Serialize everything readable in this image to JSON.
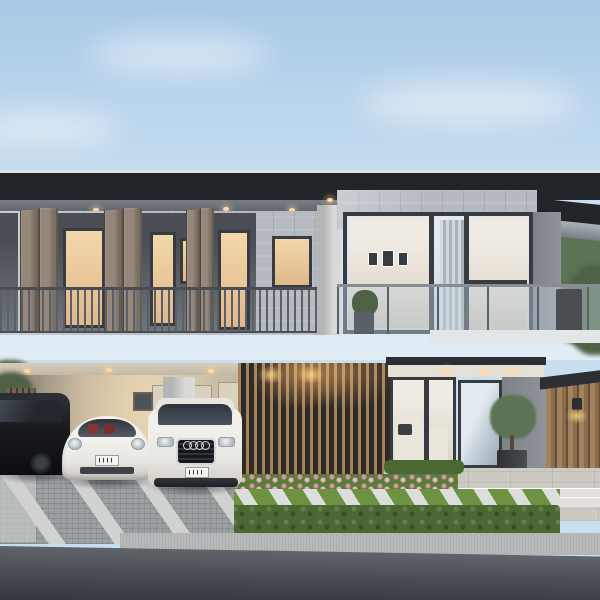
{
  "scene": {
    "type": "architectural exterior rendering",
    "time_of_day": "dusk with interior lights on",
    "description": "Modern two-storey house with dark flat cantilevered roof, stone-clad upper facade with folding taupe shutters and lit glass doors, full-height glazed corner, glass and metal balustrades, timber slat entrance screen, carport with three vehicles, manicured hedge, lawn with diagonal stepping stones and asphalt road in the foreground",
    "objects": [
      "sky",
      "clouds",
      "flat-roof",
      "eave-downlights",
      "stone-wall",
      "folding-shutters",
      "balcony-railing",
      "glass-balustrade",
      "balcony-plant",
      "picture-frames",
      "vertical-blinds",
      "carport",
      "carport-downlights",
      "white-column",
      "black-minivan",
      "white-sports-coupe",
      "white-suv",
      "license-plate",
      "timber-slat-screen",
      "timber-door",
      "living-room-glazing",
      "white-sofa",
      "topiary-tree-in-planter",
      "timber-clad-wall",
      "wall-sconce",
      "terrace",
      "steps",
      "flower-bed",
      "hedge",
      "lawn-stepping-stones",
      "garden-light",
      "paved-driveway",
      "sidewalk",
      "asphalt-road",
      "trees"
    ],
    "vehicles": [
      {
        "name": "minivan",
        "color": "black",
        "position": "left"
      },
      {
        "name": "sports coupe",
        "color": "white with red interior",
        "position": "center"
      },
      {
        "name": "suv with four-ring badge",
        "color": "white",
        "position": "right"
      }
    ]
  },
  "palette": {
    "sky1": "#a9c9e6",
    "sky2": "#c8dff0",
    "sky3": "#e2edf5",
    "roof": "#212428",
    "roofEdge": "#dde3e8",
    "soffit": "#787e85",
    "soffitDk": "#5d6369",
    "soffitLt": "#aab2b9",
    "lampWarm": "#ffd9a0",
    "stone": "#b5bac1",
    "recess": "#4a4e54",
    "recessLo": "#70767d",
    "warmGlass": "#e0b88b",
    "warmHi": "#f2d7aa",
    "frame": "#383c41",
    "shutter": "#6f6356",
    "shutterHi": "#95887a",
    "railing": "#596067",
    "railingDk": "#484e54",
    "railTop": "#878d93",
    "colWhite": "#d8dad8",
    "colShade": "#b4b6b3",
    "glass": "#c6d1d9",
    "glassHi": "#e2eaef",
    "glassDk": "#9fa9b1",
    "glassWarm": "#d9d2c4",
    "intCeil": "#f0ece4",
    "intWall": "#e4ddd2",
    "intLow": "#c9c2b6",
    "blindLt": "#d2d9dd",
    "blindDk": "#aab2b9",
    "slab": "#7d8289",
    "slabHi": "#8f949a",
    "slabDk": "#606archive569",
    "slabLip": "#e2e6e9",
    "cpCeil": "#d6cdba",
    "cpCeilDk": "#bfb5a0",
    "cpWall": "#c3b6a0",
    "cpWallLt": "#dccfb6",
    "cpWallDk": "#8f8777",
    "cpPanel": "#d9d0bd",
    "fence": "#75634d",
    "wood": "#8a6c4d",
    "woodHi": "#a5825c",
    "woodDk": "#64503a",
    "woodLit": "#c89a62",
    "woodGap": "#2e2a26",
    "porchDark": "#2c2f33",
    "porchCeil": "#e5e1d6",
    "sofa": "#eae6dc",
    "treeDark": "#4f6246",
    "treeMid": "#5d7355",
    "terrace": "#ccc9c2",
    "stepLt": "#e2e1dc",
    "bedGreen": "#5c7c3a",
    "flower": "#d893a8",
    "flower2": "#e8b7c6",
    "lawn": "#6d9242",
    "pathStone": "#dcdedb",
    "hedge": "#4c6832",
    "cobble": "#9c9fa1",
    "driveLt": "#cfd2cf",
    "sidewalk": "#b7b9ba",
    "road": "#4a4e55",
    "roadHi": "#60646b",
    "roadDk": "#34383e",
    "van": "#17191d",
    "carWhite": "#e9e7e1",
    "chrome": "#d3d7da"
  }
}
